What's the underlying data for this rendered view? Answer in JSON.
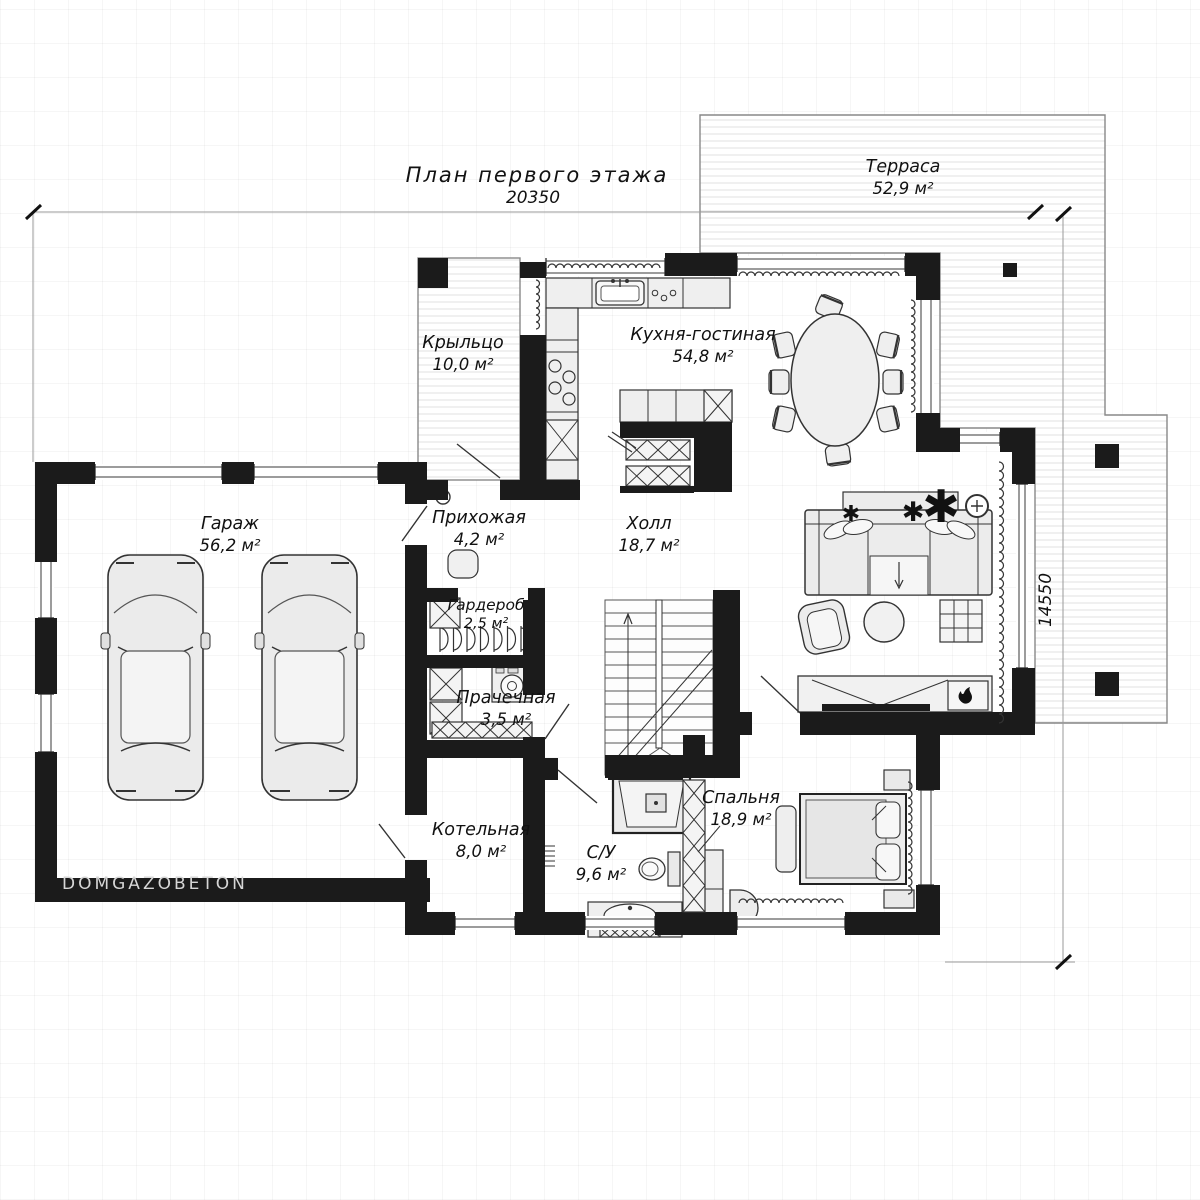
{
  "title": "План первого этажа",
  "watermark": "DOMGAZOBETON",
  "dimensions": {
    "width_mm": "20350",
    "height_mm": "14550"
  },
  "rooms": {
    "terrace": {
      "name": "Терраса",
      "area": "52,9 м²"
    },
    "porch": {
      "name": "Крыльцо",
      "area": "10,0 м²"
    },
    "kitchen_living": {
      "name": "Кухня-гостиная",
      "area": "54,8 м²"
    },
    "garage": {
      "name": "Гараж",
      "area": "56,2 м²"
    },
    "entry": {
      "name": "Прихожая",
      "area": "4,2 м²"
    },
    "hall": {
      "name": "Холл",
      "area": "18,7 м²"
    },
    "wardrobe": {
      "name": "Гардероб",
      "area": "2,5 м²"
    },
    "laundry": {
      "name": "Прачечная",
      "area": "3,5 м²"
    },
    "boiler": {
      "name": "Котельная",
      "area": "8,0 м²"
    },
    "bathroom": {
      "name": "С/У",
      "area": "9,6 м²"
    },
    "bedroom": {
      "name": "Спальня",
      "area": "18,9 м²"
    }
  }
}
